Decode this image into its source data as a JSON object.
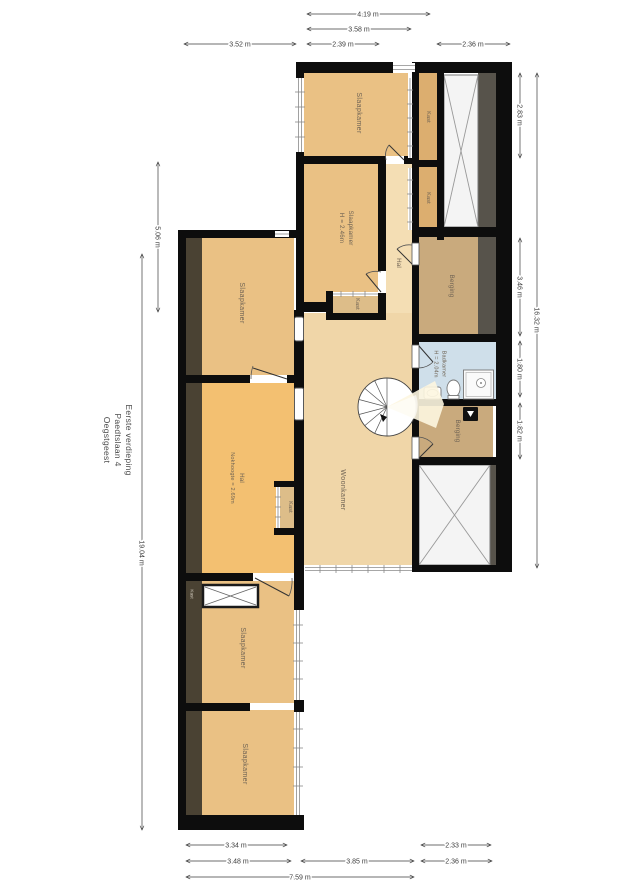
{
  "title": {
    "lines": [
      "Eerste verdieping",
      "Paedtslaan 4",
      "Oegstgeest"
    ]
  },
  "rooms": {
    "slaapkamer_top": "Slaapkamer",
    "slaapkamer_mid": "Slaapkamer",
    "slaapkamer_mid_height": "H = 2.46m",
    "slaapkamer_left": "Slaapkamer",
    "slaapkamer_bottom_mid": "Slaapkamer",
    "slaapkamer_bottom": "Slaapkamer",
    "hal_corridor": "Hal",
    "hal_left": "Hal",
    "hal_left_height": "Nokhoogte = 2.69m",
    "woonkamer": "Woonkamer",
    "badkamer": "Badkamer",
    "badkamer_height": "H = 2.04m",
    "berging_top": "Berging",
    "berging_bottom": "Berging",
    "kast_1": "Kast",
    "kast_2": "Kast",
    "kast_3": "Kast",
    "kast_4": "Kast",
    "kast_5": "Kast"
  },
  "dimensions": {
    "top": {
      "d1": "4.19 m",
      "d2": "3.58 m",
      "d3": "2.39 m",
      "d4": "2.36 m",
      "d5": "3.52 m"
    },
    "left": {
      "d1": "5.06 m",
      "d2": "19.04 m"
    },
    "right": {
      "d1": "2.83 m",
      "d2": "3.46 m",
      "d3": "1.80 m",
      "d4": "1.82 m",
      "d5": "16.32 m"
    },
    "bottom": {
      "d1": "3.34 m",
      "d2": "2.33 m",
      "d3": "3.48 m",
      "d4": "3.85 m",
      "d5": "2.36 m",
      "d6": "7.59 m"
    }
  },
  "colors": {
    "wall": "#0d0d0d",
    "bedroom": "#eac184",
    "hal_orange": "#f3c071",
    "woonkamer": "#f0d6a8",
    "corridor": "#f4deb4",
    "kast": "#dcae6f",
    "kast_small": "#ddbd89",
    "berging": "#c9aa7d",
    "badkamer": "#cfdfea",
    "roof_dark": "#4a4233",
    "roof_gray": "#57534b",
    "hatch_bg": "#f4f4f4"
  }
}
